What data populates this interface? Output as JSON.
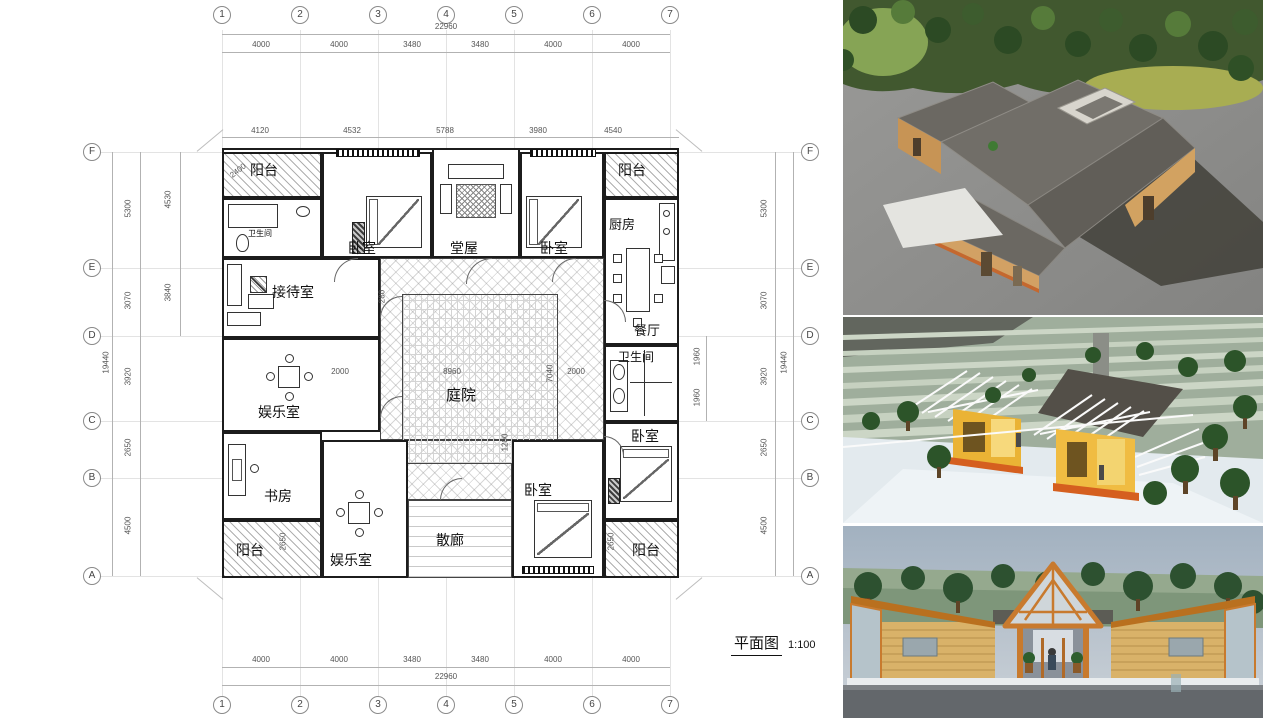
{
  "title_block": {
    "title": "平面图",
    "scale": "1:100"
  },
  "plan": {
    "grid": {
      "cols": [
        "1",
        "2",
        "3",
        "4",
        "5",
        "6",
        "7"
      ],
      "rows": [
        "F",
        "E",
        "D",
        "C",
        "B",
        "A"
      ]
    },
    "dims": {
      "top_total": "22960",
      "top_segments": [
        "4000",
        "4000",
        "3480",
        "3480",
        "4000",
        "4000"
      ],
      "top_inner": [
        "4120",
        "4532",
        "5788",
        "3980",
        "4540"
      ],
      "bottom_segments": [
        "4000",
        "4000",
        "3480",
        "3480",
        "4000",
        "4000"
      ],
      "bottom_total": "22960",
      "left_total": "19440",
      "left_segments": [
        "5300",
        "3070",
        "3920",
        "2650",
        "4500"
      ],
      "left_inner": [
        "4530",
        "3840"
      ],
      "right_segments": [
        "5300",
        "3070",
        "3920",
        "2650",
        "4500"
      ],
      "right_inner": [
        "1960",
        "1960"
      ],
      "right_total": "19440",
      "balcony_tl": "2400",
      "balcony_bl": "2650",
      "balcony_br": "2650",
      "courtyard_left": "2000",
      "courtyard_width": "8960",
      "courtyard_height": "7040",
      "courtyard_right": "2000",
      "courtyard_bottom": "1200",
      "courtyard_top": "280"
    },
    "rooms": {
      "balcony_tl": "阳台",
      "bath_tl": "卫生间",
      "bedroom_nw": "卧室",
      "hall": "堂屋",
      "bedroom_ne": "卧室",
      "balcony_tr": "阳台",
      "kitchen": "厨房",
      "dining": "餐厅",
      "reception": "接待室",
      "bath_e": "卫生间",
      "game_w": "娱乐室",
      "bedroom_e": "卧室",
      "courtyard": "庭院",
      "study": "书房",
      "balcony_bl": "阳台",
      "game_s": "娱乐室",
      "corridor": "散廊",
      "bedroom_s": "卧室",
      "balcony_br": "阳台"
    }
  },
  "renders": [
    {
      "name": "aerial-courtyard-house-render"
    },
    {
      "name": "timber-frame-pavilions-render"
    },
    {
      "name": "front-elevation-render"
    }
  ]
}
